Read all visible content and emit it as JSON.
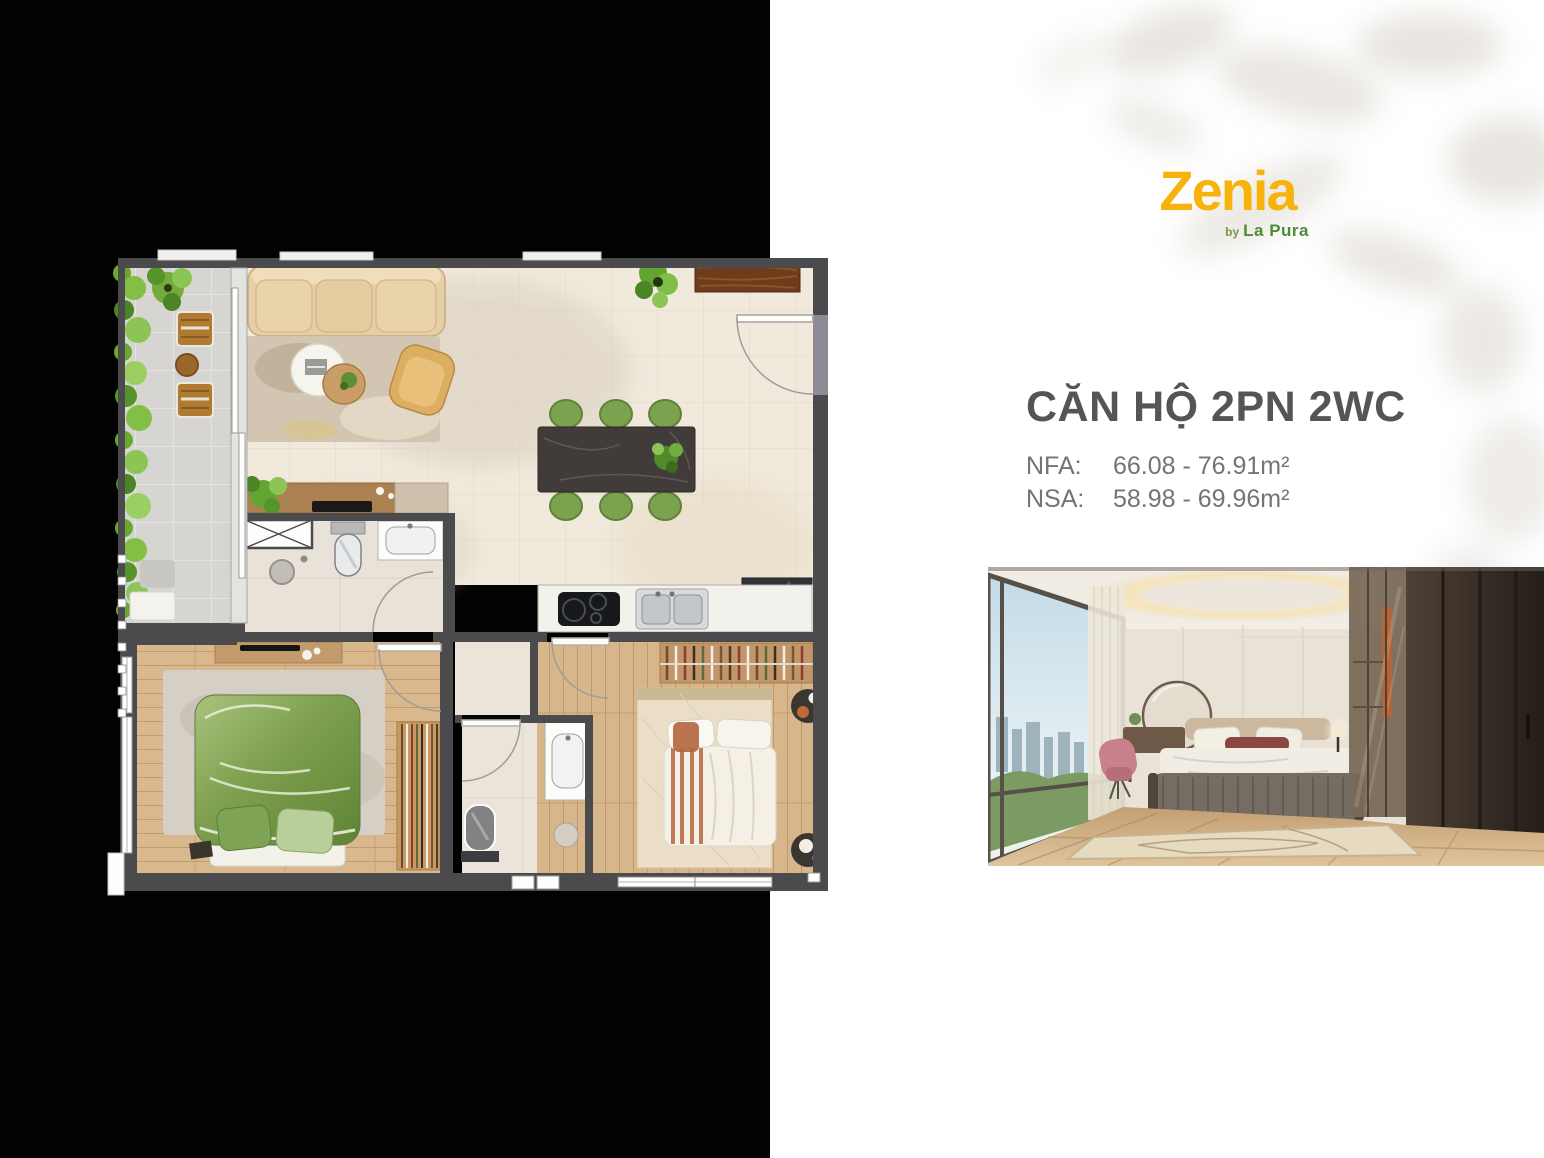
{
  "brand": {
    "name": "Zenia",
    "by": "by",
    "company": "La Pura"
  },
  "unit": {
    "title": "CĂN HỘ 2PN 2WC",
    "specs": [
      {
        "label": "NFA:",
        "value": "66.08 - 76.91m²"
      },
      {
        "label": "NSA:",
        "value": "58.98 - 69.96m²"
      }
    ]
  },
  "colors": {
    "brand_yellow": "#F7B30B",
    "brand_green": "#4E8C35",
    "title_gray": "#565457",
    "spec_gray": "#747477",
    "panel_black": "#020202",
    "plan_wall_gray": "#4B4A4C",
    "leaf_shadow": "#D9D3CB"
  },
  "floor_plan": {
    "elements": [
      "balcony",
      "living-room",
      "sofa",
      "coffee-table",
      "armchair",
      "dining-table",
      "dining-chairs",
      "kitchen-counter",
      "sink",
      "cooktop",
      "fridge-cabinet",
      "sideboard",
      "bathroom-1",
      "toilet",
      "wash-basin",
      "shower",
      "shaft",
      "bedroom-1",
      "green-bed",
      "wardrobe",
      "bathroom-2",
      "bedroom-2",
      "double-bed",
      "entry-door",
      "door-swing-arcs",
      "window-symbols",
      "dimension-ticks",
      "plants"
    ]
  },
  "photo": {
    "elements": [
      "window-city-view",
      "sheer-curtain",
      "round-mirror",
      "vanity-desk",
      "pink-chair",
      "bed-headboard",
      "pillows",
      "maroon-pillow",
      "white-duvet",
      "upholstered-bench",
      "bedside-lamp",
      "glass-wardrobe",
      "dark-wardrobe",
      "cove-ceiling-light",
      "wood-floor",
      "area-rug"
    ]
  }
}
